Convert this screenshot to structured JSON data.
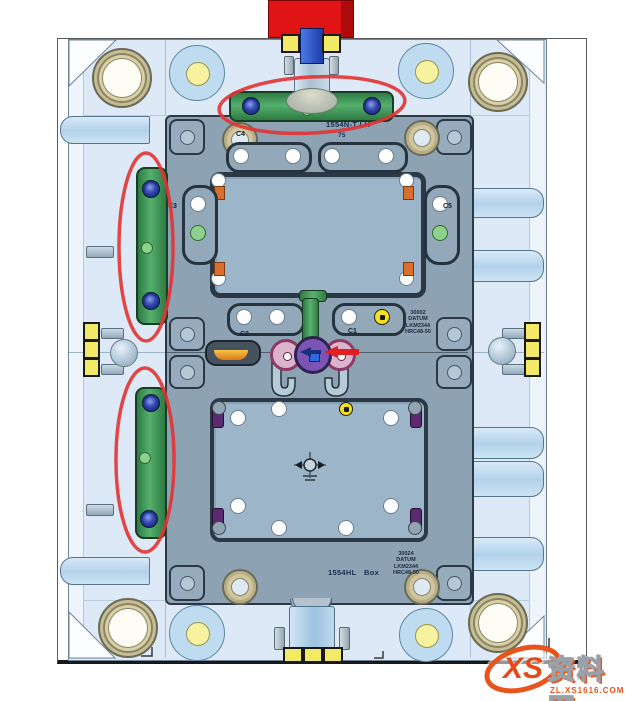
{
  "drawing": {
    "top_marking": {
      "line1": "1554N-T  LH",
      "line2": "75"
    },
    "bottom_marking": {
      "part": "1554HL",
      "desc": "Box"
    },
    "clamp_labels": {
      "c1": "C1",
      "c2": "C2",
      "c3": "C3",
      "c4": "C4",
      "c5": "C5"
    },
    "core_datum_block": [
      "30002",
      "DATUM",
      "LKM2344",
      "HRC48-50"
    ],
    "cavity_datum_block": [
      "30024",
      "DATUM",
      "LKM2344",
      "HRC48-50"
    ]
  },
  "watermark": {
    "logo": "XS",
    "site_name": "资料网",
    "url": "ZL.XS1616.COM"
  },
  "colors": {
    "plate_blue": "#dde9f6",
    "core_plate_gray": "#8da3b4",
    "green_bar": "#3f9e58",
    "annotation_red": "#e23333",
    "locating_block_red": "#e01414",
    "highlight_yellow": "#f2e968",
    "watermark_orange": "#e8541c"
  }
}
